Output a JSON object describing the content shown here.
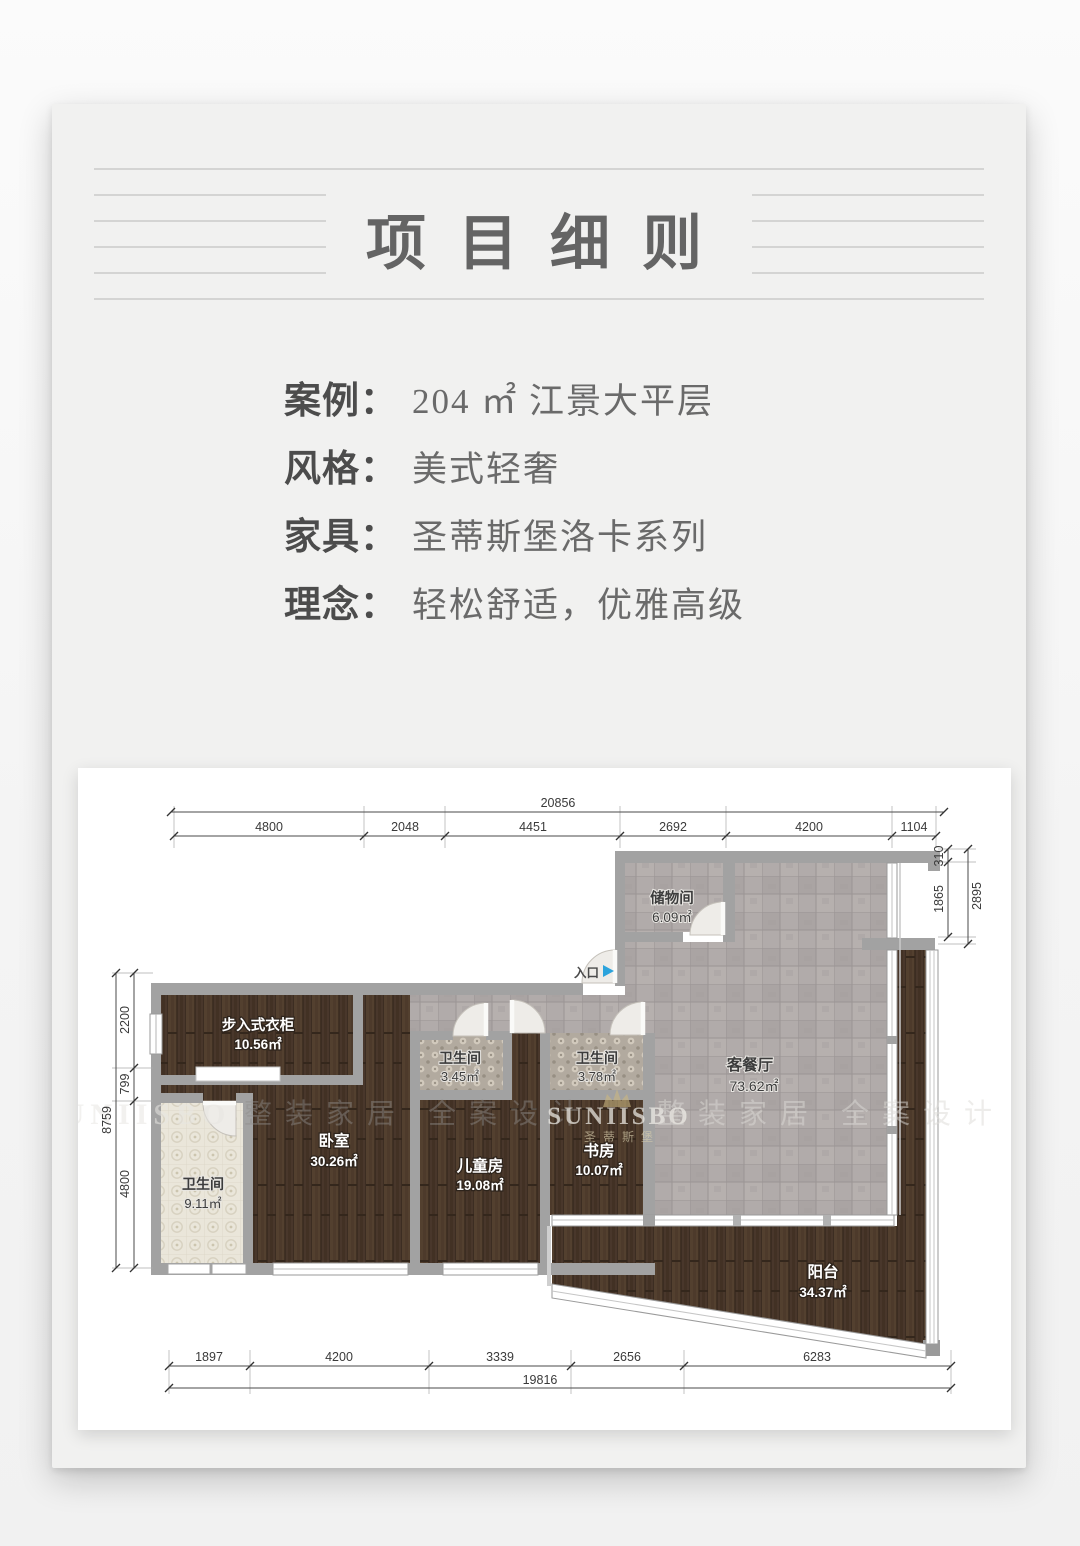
{
  "title": {
    "text": "项目细则"
  },
  "info": {
    "rows": [
      {
        "label": "案例：",
        "value": "204 ㎡ 江景大平层"
      },
      {
        "label": "风格：",
        "value": "美式轻奢"
      },
      {
        "label": "家具：",
        "value": "圣蒂斯堡洛卡系列"
      },
      {
        "label": "理念：",
        "value": "轻松舒适，优雅高级"
      }
    ]
  },
  "floorplan": {
    "entrance": "入口",
    "rooms": {
      "storage": {
        "name": "储物间",
        "area": "6.09㎡"
      },
      "living": {
        "name": "客餐厅",
        "area": "73.62㎡"
      },
      "closet": {
        "name": "步入式衣柜",
        "area": "10.56㎡"
      },
      "bath_a": {
        "name": "卫生间",
        "area": "3.45㎡"
      },
      "bath_b": {
        "name": "卫生间",
        "area": "3.78㎡"
      },
      "bedroom": {
        "name": "卧室",
        "area": "30.26㎡"
      },
      "kids": {
        "name": "儿童房",
        "area": "19.08㎡"
      },
      "study": {
        "name": "书房",
        "area": "10.07㎡"
      },
      "bath_c": {
        "name": "卫生间",
        "area": "9.11㎡"
      },
      "balcony": {
        "name": "阳台",
        "area": "34.37㎡"
      }
    },
    "dims": {
      "top_total": "20856",
      "top": [
        "4800",
        "2048",
        "4451",
        "2692",
        "4200",
        "1104"
      ],
      "bottom": [
        "1897",
        "4200",
        "3339",
        "2656",
        "6283"
      ],
      "bottom_total": "19816",
      "left": [
        "2200",
        "799",
        "4800"
      ],
      "left_total": "8759",
      "right": [
        "310",
        "1865"
      ],
      "right_total": "2895"
    },
    "watermarks": {
      "brand": "SUNIISBO",
      "brand_cn": "圣蒂斯堡",
      "slogan": "整装家居 全案设计"
    }
  },
  "colors": {
    "accent_blue": "#2ba3dc",
    "wall_gray": "#a2a2a2",
    "wood_brown": "#4c3a2d",
    "tile_gray": "#b0aaa7",
    "card_bg": "#f1f1f0"
  }
}
